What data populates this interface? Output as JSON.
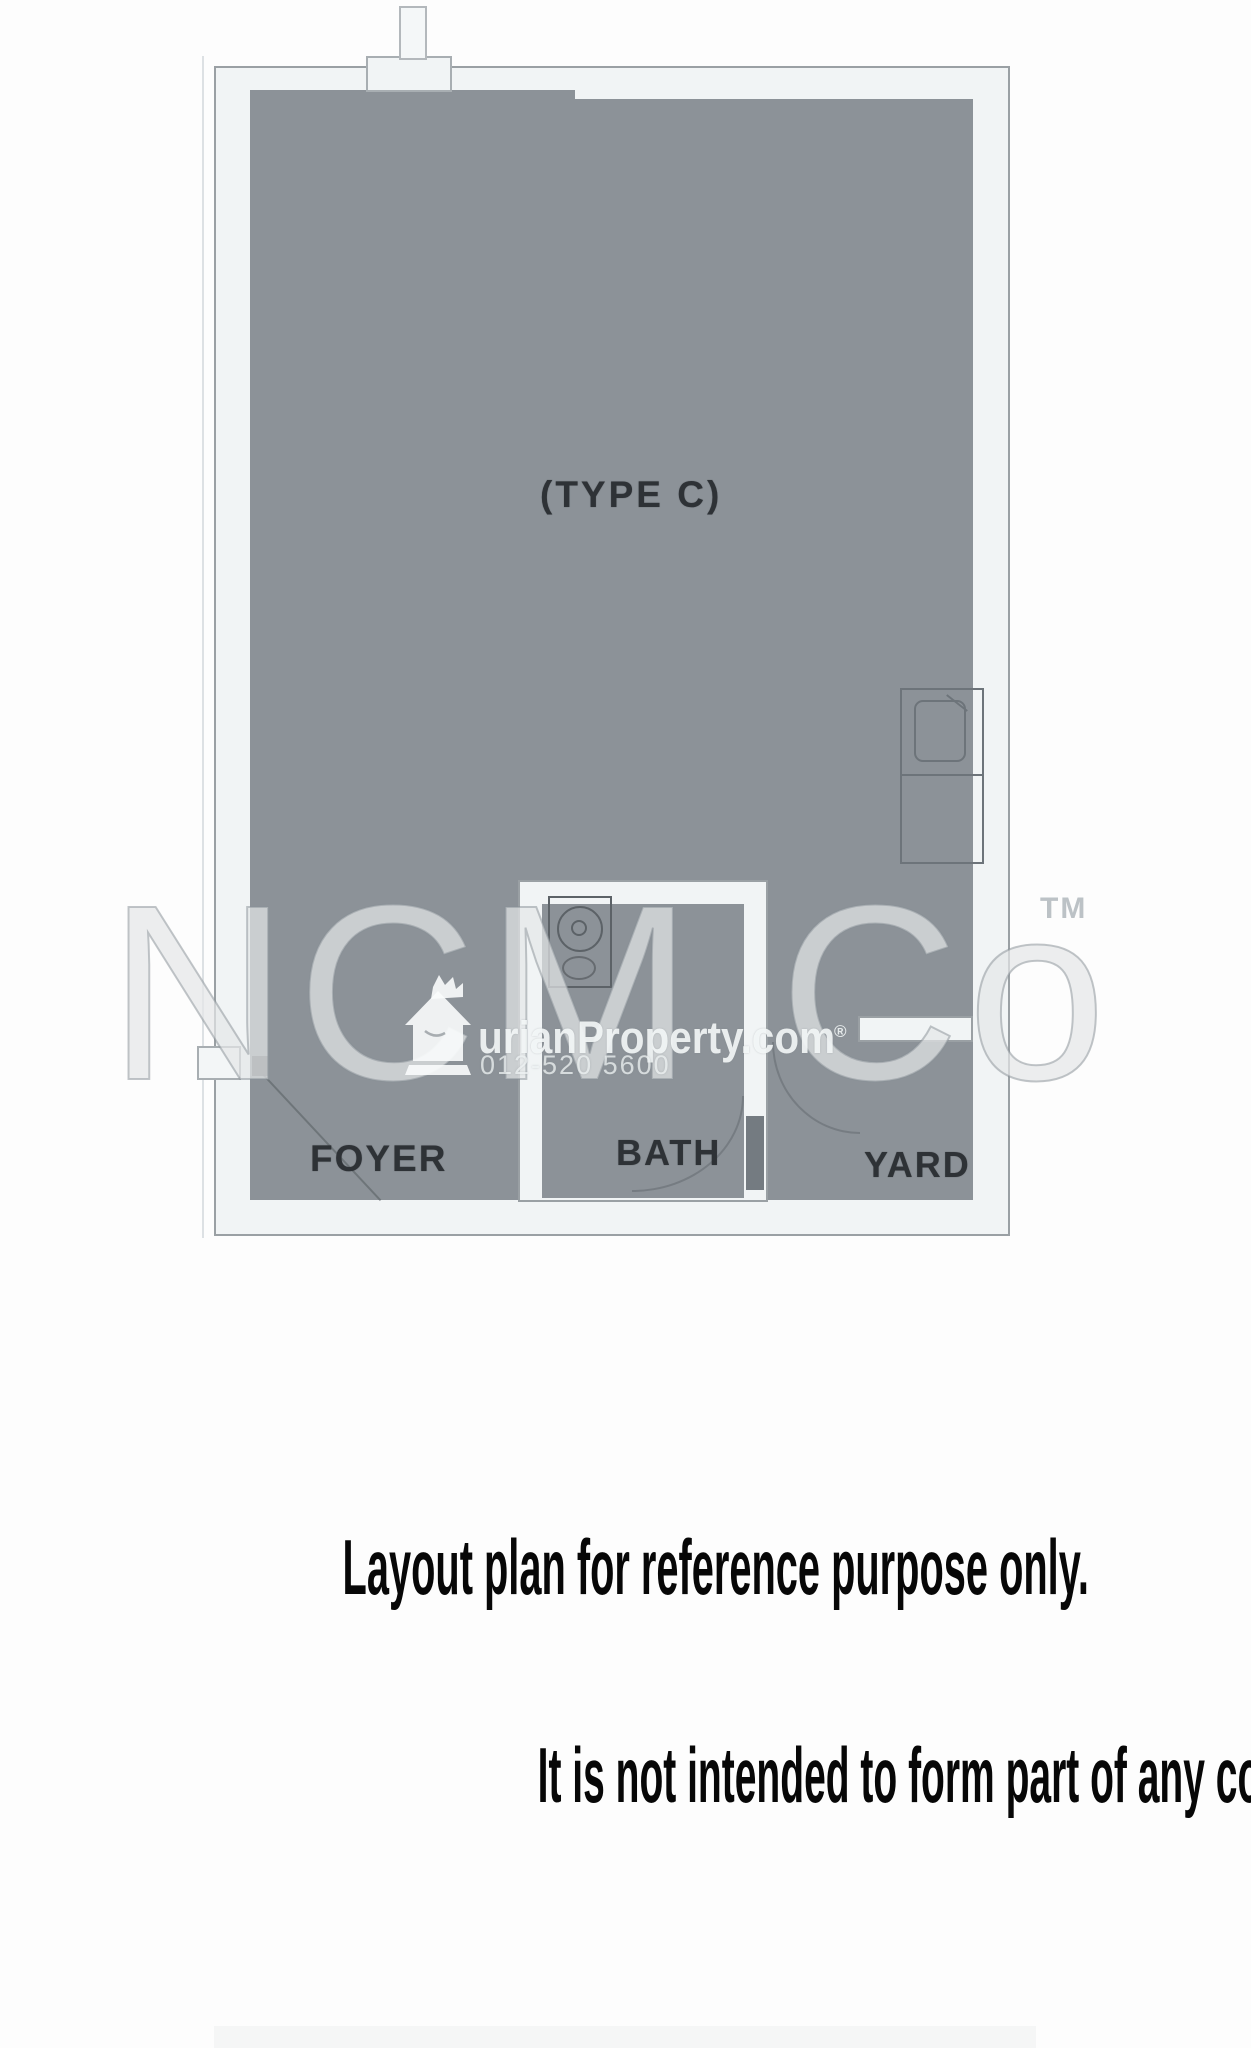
{
  "floor_plan": {
    "unit_type_label": "(TYPE C)",
    "rooms": [
      {
        "name": "FOYER"
      },
      {
        "name": "BATH"
      },
      {
        "name": "YARD"
      }
    ],
    "colors": {
      "floor_fill": "#8c9298",
      "wall_fill": "#f1f4f5",
      "wall_line": "#9aa0a4",
      "label_text": "#2e3236"
    }
  },
  "watermarks": {
    "agency_name": "NCM Co",
    "agency_trademark": "TM",
    "portal": {
      "logo_icon": "durian-house-crown-icon",
      "logo_text": "urianProperty.com",
      "registered_mark": "®",
      "phone": "012-520 5600"
    }
  },
  "disclaimer": {
    "line1": "Layout plan for reference purpose only.",
    "line2": "It is not intended to form part of any contract or warranty."
  }
}
